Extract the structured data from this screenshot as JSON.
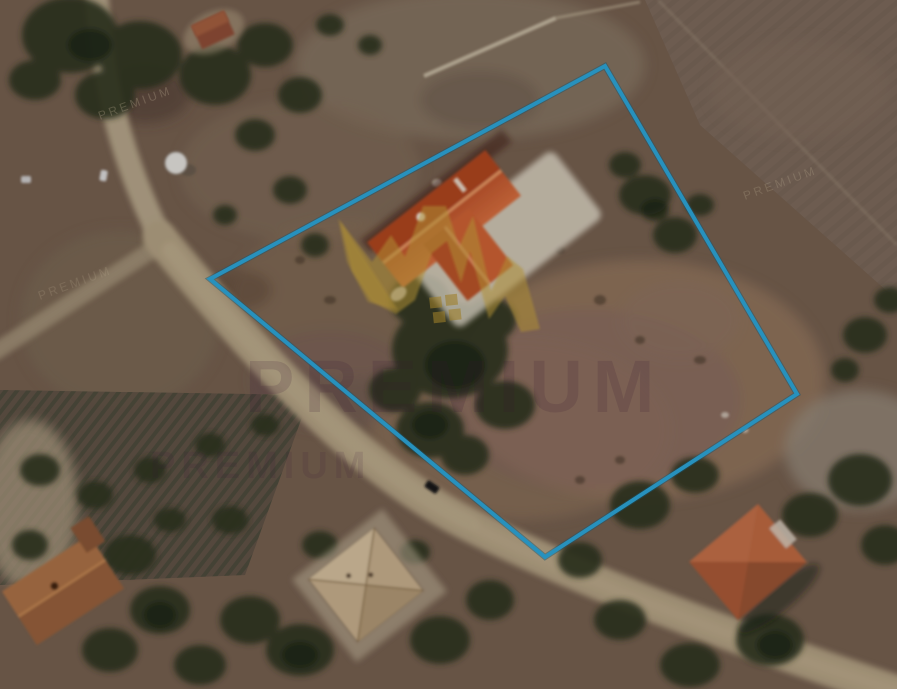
{
  "map": {
    "alt_text": "Aerial satellite view of a rural land parcel outlined in blue, with a detached orange-roofed house inside the parcel, dirt roads, trees, a plowed field and neighbouring houses",
    "parcel": {
      "polygon_points": "605,66 797,394 545,557 210,279",
      "outline_color": "#2BA7DB",
      "outline_shadow_color": "#16617F"
    },
    "watermark": {
      "brand_text": "PREMIUM",
      "brand_text_secondary": "PREMIUM",
      "tiled_text": "PREMIUM",
      "text_color": "#3F1D3C",
      "logo_color": "#C9A53B",
      "logo_zigzag_points": "340,221 372,262 391,235 405,257 423,206 446,206 459,247 473,216 491,291 507,256 523,269 540,329 521,332 505,296 489,319 470,251 461,283 447,241 432,253 415,300 396,314 371,301 352,271"
    },
    "palette": {
      "terrain_base": "#75604E",
      "road_tan": "#B4A383",
      "field_brown": "#7C6A5B",
      "tree_dark": "#2B3520",
      "main_roof_orange": "#D4693A",
      "neighbor_roof_orange": "#B2613C",
      "neighbor_roof_beige": "#C9B28E",
      "neighbor_roof_brown": "#98613B",
      "terrace_white": "#E7E1CF"
    }
  }
}
